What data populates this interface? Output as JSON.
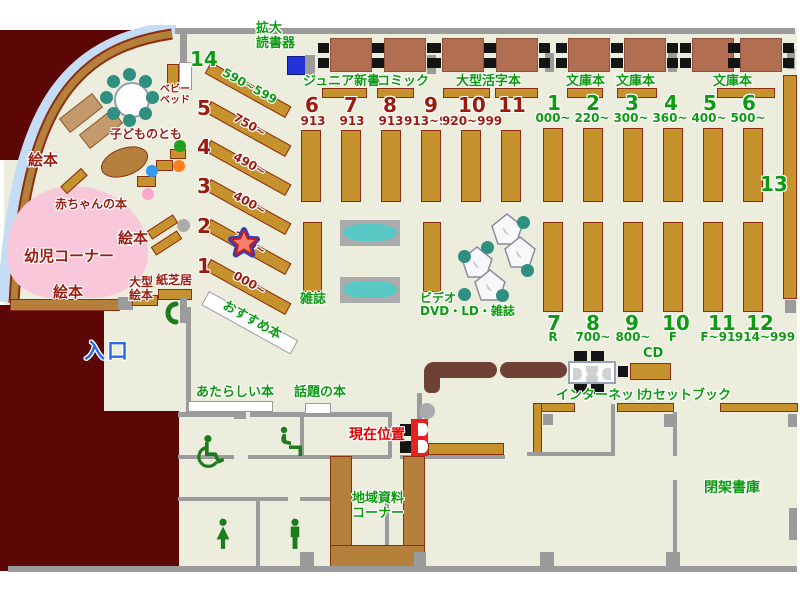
{
  "title": "library-floor-map",
  "colors": {
    "green": "#0E9A12",
    "dark_red": "#9A1C10",
    "blue": "#2B6BE6",
    "red": "#E80000",
    "shelf_brown": "#C6922E",
    "wall_gray": "#9B9B9B",
    "maroon": "#5C0606",
    "floor": "#ECEDDC",
    "pink": "#F8C8DA",
    "teal": "#2F8F80",
    "counter_brown": "#6E4134",
    "marker_blue": "#2233D9"
  },
  "top": {
    "magnifier": "拡大\n読書器",
    "junior": "ジュニア新書",
    "comic": "コミック",
    "large_print": "大型活字本",
    "bunko": "文庫本"
  },
  "sections_red": [
    {
      "no": "6",
      "range": "913"
    },
    {
      "no": "7",
      "range": "913"
    },
    {
      "no": "8",
      "range": "913"
    },
    {
      "no": "9",
      "range": "913~919"
    },
    {
      "no": "10",
      "range": "920~999"
    },
    {
      "no": "11",
      "range": ""
    }
  ],
  "sections_green_top": [
    {
      "no": "1",
      "range": "000~"
    },
    {
      "no": "2",
      "range": "220~"
    },
    {
      "no": "3",
      "range": "300~"
    },
    {
      "no": "4",
      "range": "360~"
    },
    {
      "no": "5",
      "range": "400~"
    },
    {
      "no": "6",
      "range": "500~"
    }
  ],
  "sections_green_bottom": [
    {
      "no": "7",
      "range": "R"
    },
    {
      "no": "8",
      "range": "700~"
    },
    {
      "no": "9",
      "range": "800~"
    },
    {
      "no": "10",
      "range": "F"
    },
    {
      "no": "11",
      "range": "F~914"
    },
    {
      "no": "12",
      "range": "914~999"
    }
  ],
  "section_13": "13",
  "diag_sections": [
    {
      "no": "14",
      "range": "590~599"
    },
    {
      "no": "5",
      "range": "750~"
    },
    {
      "no": "4",
      "range": "490~"
    },
    {
      "no": "3",
      "range": "400~"
    },
    {
      "no": "2",
      "range": "280~"
    },
    {
      "no": "1",
      "range": "000~"
    }
  ],
  "center": {
    "magazines": "雑誌",
    "av": "ビデオ・\nDVD・LD・雑誌",
    "recommended": "おすすめ本"
  },
  "children": {
    "corner": "幼児コーナー",
    "picture_books": "絵本",
    "baby_books": "赤ちゃんの本",
    "kodomo_no_tomo": "子どものとも",
    "baby_bed": "ベビー\nベッド",
    "large_picture_books": "大型\n絵本",
    "kamishibai": "紙芝居"
  },
  "south": {
    "new_books": "あたらしい本",
    "topic_books": "話題の本",
    "internet": "インターネット",
    "cd": "CD",
    "cassette": "カセットブック",
    "local_corner": "地域資料\nコーナー",
    "closed_stacks": "閉架書庫",
    "current_position": "現在位置",
    "entrance": "入口"
  }
}
